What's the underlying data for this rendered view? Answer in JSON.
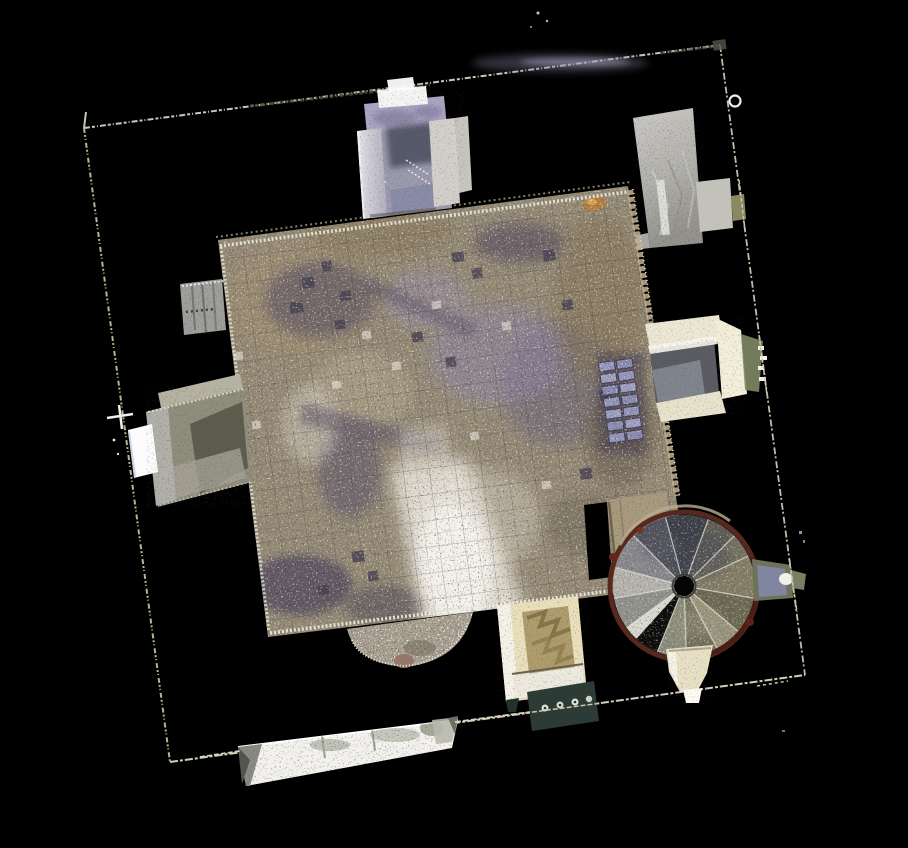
{
  "viewport": {
    "width": 908,
    "height": 848,
    "background": "#000000"
  },
  "scene": {
    "kind": "top-down-point-cloud-scan",
    "subject": "chapel interior scan viewed from above",
    "elements": [
      "outer-boundary-wall-outline",
      "north-entrance-porch",
      "northeast-roof-slab",
      "east-window-alcove",
      "west-window-alcove",
      "west-wall-patch",
      "south-apse",
      "south-chapel-alcove",
      "chapel-railing-ornament",
      "main-tiled-floor",
      "floor-radiator-grid",
      "stair-passage",
      "spiral-staircase-tower",
      "stair-newel-hole",
      "stair-east-window",
      "stair-south-funnel",
      "south-wall-band",
      "survey-ring-marker",
      "survey-cross-marker"
    ]
  },
  "palette": {
    "background": "#000000",
    "boundary_line": "#d6d2c2",
    "boundary_line_olive": "#47523f",
    "floor_base": "#958a74",
    "floor_shadow_purple": "#564e62",
    "floor_lavender": "#8d86a4",
    "floor_highlight": "#f2efe6",
    "porch_lavender": "#a9a5c2",
    "pillar_gray": "#cdccd4",
    "alcove_cream": "#ece7d2",
    "chapel_cream": "#eadfbb",
    "railing_teal": "#2c3b36",
    "stair_rim_maroon": "#56281e",
    "stair_step_olive": "#837d66",
    "stair_step_slate": "#3d3f47",
    "stair_step_white": "#d7d7cd",
    "wall_band_white": "#f2f1ec",
    "slab_gray": "#c6c5c0",
    "apse_speckle": "#a59d8d",
    "radiator_blue": "#999dc4",
    "orange_tile": "#b57f3c"
  }
}
